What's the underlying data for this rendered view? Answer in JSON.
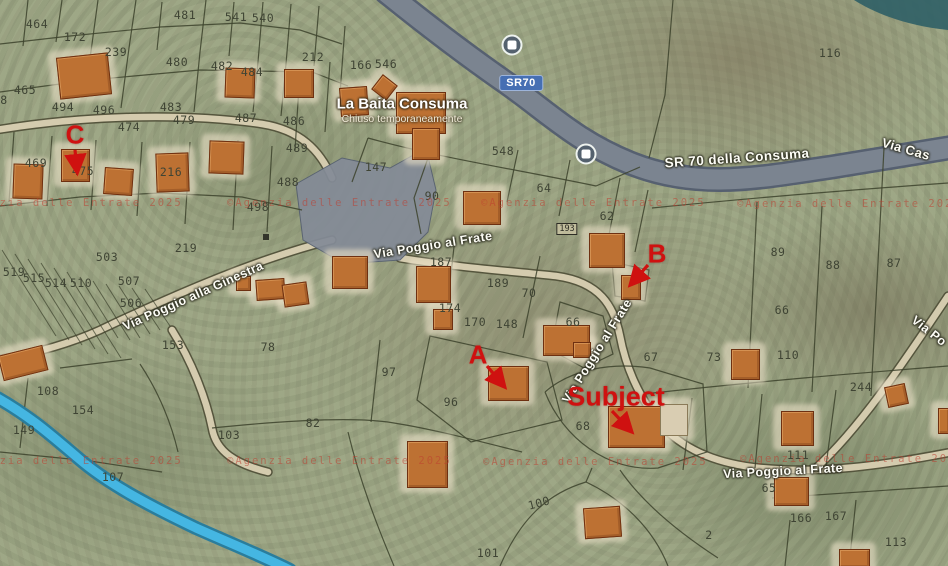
{
  "map": {
    "canvas": {
      "width": 948,
      "height": 566,
      "background": "#9fa988"
    },
    "poi": {
      "name": "La Baita Consuma",
      "status": "Chiuso temporaneamente",
      "x": 402,
      "y": 104,
      "status_y": 119
    },
    "route_shield": {
      "text": "SR70",
      "x": 521,
      "y": 83,
      "color": "#466fb3"
    },
    "road_labels": [
      {
        "text": "SR 70 della Consuma",
        "x": 737,
        "y": 158,
        "rot": -4,
        "size": 13.5
      },
      {
        "text": "Via Cas",
        "x": 906,
        "y": 149,
        "rot": 16,
        "size": 13
      },
      {
        "text": "Via Poggio al Frate",
        "x": 433,
        "y": 245,
        "rot": -9,
        "size": 12.5
      },
      {
        "text": "Via Poggio al Frate",
        "x": 597,
        "y": 351,
        "rot": -58,
        "size": 12.5
      },
      {
        "text": "Via Poggio al Frate",
        "x": 783,
        "y": 471,
        "rot": -3,
        "size": 12.5
      },
      {
        "text": "Via Po",
        "x": 929,
        "y": 331,
        "rot": 38,
        "size": 12.5
      },
      {
        "text": "Via Poggio alla Ginestra",
        "x": 193,
        "y": 296,
        "rot": -24,
        "size": 12.5
      }
    ],
    "bus_stops": [
      {
        "x": 512,
        "y": 45
      },
      {
        "x": 586,
        "y": 154
      }
    ],
    "annotation_color": "#cf1110",
    "annotations": [
      {
        "label": "C",
        "x": 75,
        "y": 135,
        "size": 26,
        "arrow": {
          "x1": 75,
          "y1": 150,
          "x2": 77,
          "y2": 170
        }
      },
      {
        "label": "B",
        "x": 657,
        "y": 254,
        "size": 26,
        "arrow": {
          "x1": 648,
          "y1": 265,
          "x2": 632,
          "y2": 283
        }
      },
      {
        "label": "A",
        "x": 478,
        "y": 355,
        "size": 26,
        "arrow": {
          "x1": 487,
          "y1": 366,
          "x2": 503,
          "y2": 385
        }
      },
      {
        "label": "Subject",
        "x": 616,
        "y": 397,
        "size": 27,
        "arrow": {
          "x1": 612,
          "y1": 411,
          "x2": 630,
          "y2": 430
        }
      }
    ],
    "watermark": {
      "text": "©Agenzia delle Entrate 2025",
      "color": "rgba(190,62,48,0.55)",
      "instances": [
        {
          "x": -42,
          "y": 203
        },
        {
          "x": 227,
          "y": 203
        },
        {
          "x": 481,
          "y": 203
        },
        {
          "x": 737,
          "y": 204
        },
        {
          "x": -42,
          "y": 461
        },
        {
          "x": 227,
          "y": 461
        },
        {
          "x": 483,
          "y": 462
        },
        {
          "x": 740,
          "y": 459
        }
      ]
    },
    "parcel_numbers": [
      {
        "n": "464",
        "x": 37,
        "y": 24
      },
      {
        "n": "172",
        "x": 75,
        "y": 37
      },
      {
        "n": "481",
        "x": 185,
        "y": 15
      },
      {
        "n": "541",
        "x": 236,
        "y": 17
      },
      {
        "n": "540",
        "x": 263,
        "y": 18
      },
      {
        "n": "239",
        "x": 116,
        "y": 52
      },
      {
        "n": "480",
        "x": 177,
        "y": 62
      },
      {
        "n": "212",
        "x": 313,
        "y": 57
      },
      {
        "n": "166",
        "x": 361,
        "y": 65
      },
      {
        "n": "546",
        "x": 386,
        "y": 64
      },
      {
        "n": "482",
        "x": 222,
        "y": 66
      },
      {
        "n": "484",
        "x": 252,
        "y": 72
      },
      {
        "n": "116",
        "x": 830,
        "y": 53
      },
      {
        "n": "465",
        "x": 25,
        "y": 90
      },
      {
        "n": "8",
        "x": 4,
        "y": 100
      },
      {
        "n": "483",
        "x": 171,
        "y": 107
      },
      {
        "n": "494",
        "x": 63,
        "y": 107
      },
      {
        "n": "496",
        "x": 104,
        "y": 110
      },
      {
        "n": "479",
        "x": 184,
        "y": 120
      },
      {
        "n": "474",
        "x": 129,
        "y": 127
      },
      {
        "n": "487",
        "x": 246,
        "y": 118
      },
      {
        "n": "486",
        "x": 294,
        "y": 121
      },
      {
        "n": "489",
        "x": 297,
        "y": 148
      },
      {
        "n": "548",
        "x": 503,
        "y": 151
      },
      {
        "n": "469",
        "x": 36,
        "y": 163
      },
      {
        "n": "475",
        "x": 83,
        "y": 171
      },
      {
        "n": "216",
        "x": 171,
        "y": 172
      },
      {
        "n": "147",
        "x": 376,
        "y": 167
      },
      {
        "n": "488",
        "x": 288,
        "y": 182
      },
      {
        "n": "64",
        "x": 544,
        "y": 188
      },
      {
        "n": "90",
        "x": 432,
        "y": 196
      },
      {
        "n": "498",
        "x": 258,
        "y": 207
      },
      {
        "n": "62",
        "x": 607,
        "y": 216
      },
      {
        "n": "219",
        "x": 186,
        "y": 248
      },
      {
        "n": "187",
        "x": 441,
        "y": 262
      },
      {
        "n": "89",
        "x": 778,
        "y": 252
      },
      {
        "n": "88",
        "x": 833,
        "y": 265
      },
      {
        "n": "87",
        "x": 894,
        "y": 263
      },
      {
        "n": "503",
        "x": 107,
        "y": 257
      },
      {
        "n": "519",
        "x": 14,
        "y": 272
      },
      {
        "n": "515",
        "x": 34,
        "y": 278
      },
      {
        "n": "514",
        "x": 56,
        "y": 283
      },
      {
        "n": "510",
        "x": 81,
        "y": 283
      },
      {
        "n": "507",
        "x": 129,
        "y": 281
      },
      {
        "n": "189",
        "x": 498,
        "y": 283
      },
      {
        "n": "70",
        "x": 529,
        "y": 293
      },
      {
        "n": "506",
        "x": 131,
        "y": 303
      },
      {
        "n": "66",
        "x": 782,
        "y": 310
      },
      {
        "n": "174",
        "x": 450,
        "y": 308
      },
      {
        "n": "170",
        "x": 475,
        "y": 322
      },
      {
        "n": "148",
        "x": 507,
        "y": 324
      },
      {
        "n": "66",
        "x": 573,
        "y": 322
      },
      {
        "n": "153",
        "x": 173,
        "y": 345
      },
      {
        "n": "78",
        "x": 268,
        "y": 347
      },
      {
        "n": "67",
        "x": 651,
        "y": 357
      },
      {
        "n": "73",
        "x": 714,
        "y": 357
      },
      {
        "n": "110",
        "x": 788,
        "y": 355
      },
      {
        "n": "97",
        "x": 389,
        "y": 372
      },
      {
        "n": "244",
        "x": 861,
        "y": 387
      },
      {
        "n": "108",
        "x": 48,
        "y": 391
      },
      {
        "n": "96",
        "x": 451,
        "y": 402
      },
      {
        "n": "154",
        "x": 83,
        "y": 410
      },
      {
        "n": "82",
        "x": 313,
        "y": 423
      },
      {
        "n": "68",
        "x": 583,
        "y": 426
      },
      {
        "n": "149",
        "x": 24,
        "y": 430
      },
      {
        "n": "103",
        "x": 229,
        "y": 435
      },
      {
        "n": "111",
        "x": 798,
        "y": 455
      },
      {
        "n": "107",
        "x": 113,
        "y": 477
      },
      {
        "n": "65",
        "x": 769,
        "y": 488
      },
      {
        "n": "100",
        "x": 539,
        "y": 503,
        "rot": -15
      },
      {
        "n": "166",
        "x": 801,
        "y": 518
      },
      {
        "n": "167",
        "x": 836,
        "y": 516
      },
      {
        "n": "2",
        "x": 709,
        "y": 535
      },
      {
        "n": "113",
        "x": 896,
        "y": 542
      },
      {
        "n": "101",
        "x": 488,
        "y": 553
      }
    ],
    "boxed_numbers": [
      {
        "text": "193",
        "x": 567,
        "y": 229
      }
    ],
    "small_markers": [
      {
        "x": 263,
        "y": 234
      }
    ],
    "buildings": [
      {
        "x": 58,
        "y": 55,
        "w": 50,
        "h": 40,
        "rot": -6
      },
      {
        "x": 225,
        "y": 68,
        "w": 28,
        "h": 28,
        "rot": 2
      },
      {
        "x": 284,
        "y": 69,
        "w": 28,
        "h": 27,
        "rot": 0
      },
      {
        "x": 340,
        "y": 87,
        "w": 26,
        "h": 27,
        "rot": -4
      },
      {
        "x": 375,
        "y": 78,
        "w": 17,
        "h": 17,
        "rot": 38
      },
      {
        "x": 396,
        "y": 92,
        "w": 48,
        "h": 40,
        "rot": 0
      },
      {
        "x": 412,
        "y": 128,
        "w": 26,
        "h": 30,
        "rot": 0
      },
      {
        "x": 13,
        "y": 164,
        "w": 28,
        "h": 33,
        "rot": 2
      },
      {
        "x": 61,
        "y": 149,
        "w": 27,
        "h": 31,
        "rot": 0
      },
      {
        "x": 104,
        "y": 168,
        "w": 27,
        "h": 25,
        "rot": 4
      },
      {
        "x": 156,
        "y": 153,
        "w": 31,
        "h": 37,
        "rot": -2
      },
      {
        "x": 209,
        "y": 141,
        "w": 33,
        "h": 31,
        "rot": 2
      },
      {
        "x": 463,
        "y": 191,
        "w": 36,
        "h": 32,
        "rot": 0
      },
      {
        "x": 332,
        "y": 256,
        "w": 34,
        "h": 31,
        "rot": 0
      },
      {
        "x": 416,
        "y": 266,
        "w": 33,
        "h": 35,
        "rot": 0
      },
      {
        "x": 433,
        "y": 309,
        "w": 18,
        "h": 19,
        "rot": 0
      },
      {
        "x": 236,
        "y": 276,
        "w": 13,
        "h": 13,
        "rot": 0
      },
      {
        "x": 256,
        "y": 279,
        "w": 27,
        "h": 19,
        "rot": -4
      },
      {
        "x": 283,
        "y": 283,
        "w": 23,
        "h": 21,
        "rot": -8
      },
      {
        "x": 589,
        "y": 233,
        "w": 34,
        "h": 33,
        "rot": 0
      },
      {
        "x": 621,
        "y": 275,
        "w": 18,
        "h": 23,
        "rot": 0
      },
      {
        "x": 543,
        "y": 325,
        "w": 45,
        "h": 29,
        "rot": 0
      },
      {
        "x": 573,
        "y": 342,
        "w": 16,
        "h": 14,
        "rot": 0
      },
      {
        "x": 488,
        "y": 366,
        "w": 39,
        "h": 33,
        "rot": 0
      },
      {
        "x": 608,
        "y": 406,
        "w": 55,
        "h": 40,
        "rot": 0
      },
      {
        "x": 660,
        "y": 404,
        "w": 26,
        "h": 30,
        "rot": 0,
        "annex": true
      },
      {
        "x": 731,
        "y": 349,
        "w": 27,
        "h": 29,
        "rot": 0
      },
      {
        "x": 886,
        "y": 385,
        "w": 19,
        "h": 19,
        "rot": -12
      },
      {
        "x": 781,
        "y": 411,
        "w": 31,
        "h": 33,
        "rot": 0
      },
      {
        "x": 774,
        "y": 477,
        "w": 33,
        "h": 27,
        "rot": 0
      },
      {
        "x": 584,
        "y": 507,
        "w": 35,
        "h": 29,
        "rot": -4
      },
      {
        "x": 407,
        "y": 441,
        "w": 39,
        "h": 45,
        "rot": 0
      },
      {
        "x": 839,
        "y": 549,
        "w": 29,
        "h": 17,
        "rot": 0
      },
      {
        "x": 0,
        "y": 350,
        "w": 44,
        "h": 24,
        "rot": -14
      },
      {
        "x": 938,
        "y": 408,
        "w": 10,
        "h": 24,
        "rot": 0
      }
    ],
    "svg": {
      "water": {
        "d": "M854,0 L948,0 L948,30 C908,26 876,14 854,0 Z",
        "fill": "#2f5f66"
      },
      "plaza": {
        "d": "M296,184 L342,158 L390,168 L426,148 L436,190 L428,232 L400,260 L344,264 L303,240 Z",
        "fill": "#848b97",
        "stroke": "#566070"
      },
      "highway": {
        "d": "M386,-8 C428,26 462,52 505,82 C548,112 574,140 630,163 C700,191 762,177 832,167 C882,159 922,152 954,147",
        "casing": "#566070",
        "fill": "#7b8490",
        "casing_w": 25,
        "fill_w": 20
      },
      "roads": [
        {
          "d": "M-4,130 C80,116 180,112 262,124 C300,130 320,150 332,178"
        },
        {
          "d": "M332,240 C260,258 180,292 100,330 C60,348 20,356 -4,360"
        },
        {
          "d": "M172,330 C192,362 206,398 212,428 C216,452 236,464 268,472"
        },
        {
          "d": "M400,258 C460,268 520,272 556,276 C600,282 614,306 620,336 C626,368 640,400 664,428 C688,452 720,464 760,468 C820,474 880,466 952,452"
        },
        {
          "d": "M816,468 C858,430 900,368 948,296"
        }
      ],
      "road_casing": "#55553d",
      "road_fill": "#d4cbae",
      "stream": {
        "d": "M-6,396 C30,416 52,436 78,458 C108,484 150,506 196,528 C232,544 262,556 290,570",
        "casing": "#2a7d9c",
        "fill": "#45b6e2"
      },
      "parcel_line_color": "#3c422c",
      "parcel_lines": [
        {
          "d": "M0,44 L70,36 L160,27 L240,23 L300,30 L342,44"
        },
        {
          "d": "M28,0 L23,46"
        },
        {
          "d": "M62,0 L56,42"
        },
        {
          "d": "M98,0 L92,44 L85,94"
        },
        {
          "d": "M136,0 L129,48 L121,108"
        },
        {
          "d": "M162,2 L157,50"
        },
        {
          "d": "M206,0 L200,52 L194,112"
        },
        {
          "d": "M234,2 L229,56"
        },
        {
          "d": "M263,2 L258,62 L253,112"
        },
        {
          "d": "M291,4 L286,64 L281,116"
        },
        {
          "d": "M319,6 L314,66"
        },
        {
          "d": "M345,26 L340,94"
        },
        {
          "d": "M0,92 L90,80 L200,70 L312,72 L348,86"
        },
        {
          "d": "M300,70 L295,150"
        },
        {
          "d": "M330,62 L325,132"
        },
        {
          "d": "M14,132 L9,202"
        },
        {
          "d": "M52,136 L47,206"
        },
        {
          "d": "M96,140 L91,210"
        },
        {
          "d": "M142,142 L137,216"
        },
        {
          "d": "M190,142 L185,224"
        },
        {
          "d": "M238,140 L233,230"
        },
        {
          "d": "M272,146 L267,232"
        },
        {
          "d": "M0,206 L80,197 L160,193 L242,197 L302,210"
        },
        {
          "d": "M368,138 C440,158 520,170 596,186"
        },
        {
          "d": "M352,182 L368,138"
        },
        {
          "d": "M596,186 L640,167"
        },
        {
          "d": "M428,158 L414,198 L421,234"
        },
        {
          "d": "M518,150 L507,202"
        },
        {
          "d": "M570,160 L559,216"
        },
        {
          "d": "M620,178 L608,240"
        },
        {
          "d": "M648,190 L635,252"
        },
        {
          "d": "M652,208 C750,198 850,190 948,183"
        },
        {
          "d": "M757,202 L748,388"
        },
        {
          "d": "M822,206 L812,392"
        },
        {
          "d": "M884,148 L871,396"
        },
        {
          "d": "M644,394 C760,381 860,373 948,366"
        },
        {
          "d": "M692,398 L683,470"
        },
        {
          "d": "M762,394 L755,468"
        },
        {
          "d": "M836,390 L826,466"
        },
        {
          "d": "M455,238 L446,318"
        },
        {
          "d": "M540,256 L523,338"
        },
        {
          "d": "M560,302 L603,316 L613,354 L584,368 L551,350 Z"
        },
        {
          "d": "M612,262 L649,270 L645,301 L615,296 Z"
        },
        {
          "d": "M545,392 C570,370 610,362 650,368 L703,384 L707,452 L658,468 C608,472 563,438 545,392"
        },
        {
          "d": "M430,336 L547,362 L562,420 L471,442 L417,400 Z"
        },
        {
          "d": "M380,340 L371,422"
        },
        {
          "d": "M212,428 C300,419 360,417 394,423 C432,429 474,440 522,452"
        },
        {
          "d": "M348,432 C360,482 378,528 394,566"
        },
        {
          "d": "M500,566 C520,520 546,494 586,482 C620,498 652,526 668,566"
        },
        {
          "d": "M586,482 L592,468"
        },
        {
          "d": "M60,368 L132,359"
        },
        {
          "d": "M28,378 L20,448"
        },
        {
          "d": "M140,364 C160,394 172,426 178,452"
        },
        {
          "d": "M0,452 L90,461 L162,472"
        },
        {
          "d": "M772,498 L948,486"
        },
        {
          "d": "M856,500 L849,566"
        },
        {
          "d": "M790,520 L785,566"
        },
        {
          "d": "M620,470 C642,502 678,532 718,558"
        },
        {
          "d": "M673,0 L665,95 L649,158"
        }
      ],
      "hatch_lines": [
        {
          "d": "M2,250 L56,336"
        },
        {
          "d": "M15,254 L69,340"
        },
        {
          "d": "M28,259 L82,345"
        },
        {
          "d": "M41,263 L95,349"
        },
        {
          "d": "M54,268 L108,354"
        },
        {
          "d": "M67,272 L121,358"
        },
        {
          "d": "M80,277 L118,338"
        },
        {
          "d": "M93,281 L130,340"
        },
        {
          "d": "M106,284 L140,338"
        },
        {
          "d": "M119,286 L150,334"
        },
        {
          "d": "M132,288 L160,330"
        },
        {
          "d": "M145,289 L170,326"
        }
      ]
    }
  }
}
